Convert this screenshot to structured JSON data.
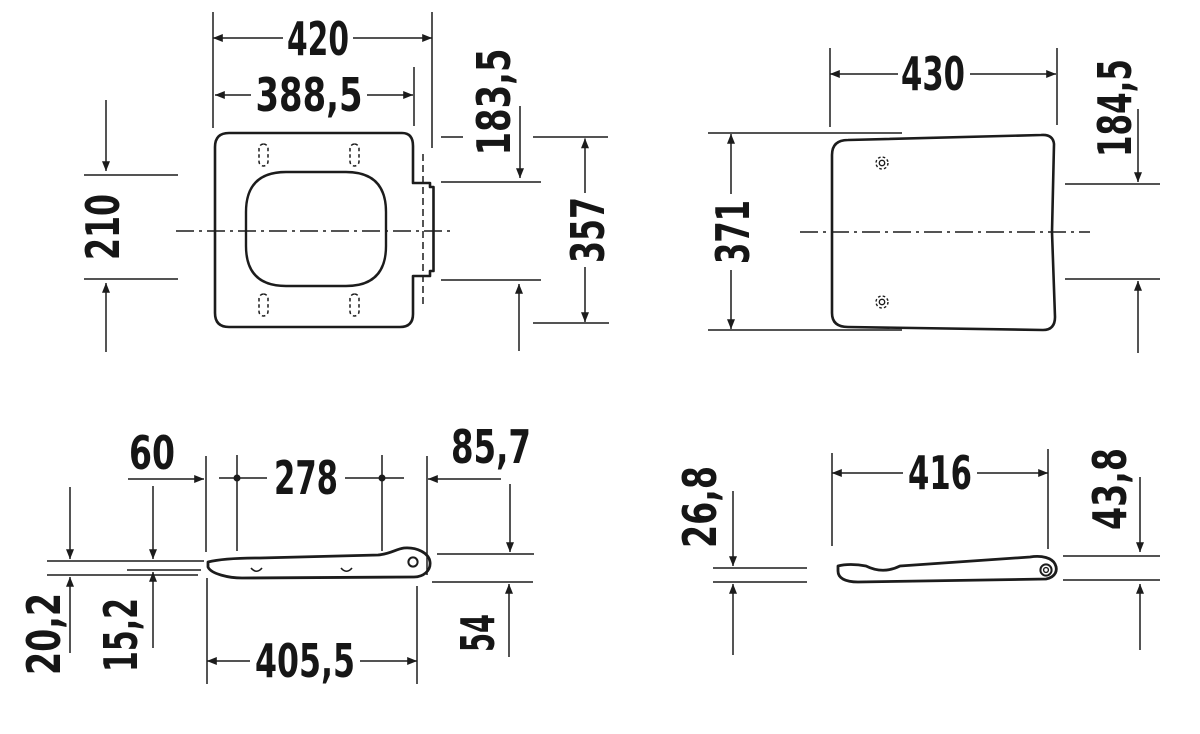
{
  "page": {
    "background": "#ffffff",
    "line_color": "#1c1c1c"
  },
  "views": {
    "seat_top": {
      "dims": {
        "overall_width": "420",
        "body_width": "388,5",
        "cutout_length": "210",
        "hinge_offset": "183,5",
        "overall_length": "357"
      }
    },
    "lid_top": {
      "dims": {
        "overall_width": "430",
        "overall_length": "371",
        "hinge_offset": "184,5"
      }
    },
    "seat_profile": {
      "dims": {
        "front_height": "60",
        "bumper_spacing": "278",
        "hinge_overhang": "85,7",
        "total_thickness": "20,2",
        "ring_thickness": "15,2",
        "underside_length": "405,5",
        "hinge_height": "54"
      }
    },
    "lid_profile": {
      "dims": {
        "front_thickness": "26,8",
        "overall_length": "416",
        "hinge_thickness": "43,8"
      }
    }
  }
}
